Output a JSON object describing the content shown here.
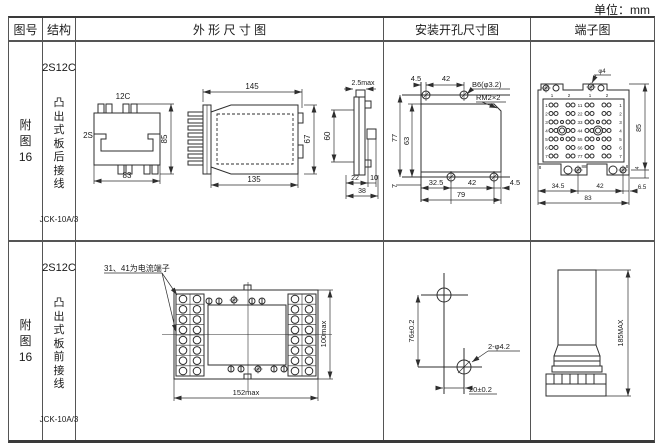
{
  "unit_label": "单位：mm",
  "table": {
    "headers": {
      "fig_no": "图号",
      "structure": "结构",
      "outline": "外 形 尺 寸 图",
      "mounting": "安装开孔尺寸图",
      "terminal": "端子图"
    }
  },
  "rows": [
    {
      "fig_no": "附\n图\n16",
      "model": "2S12C",
      "structure_desc": "凸\n出\n式\n板\n后\n接\n线",
      "relay_code": "JCK-10A/3",
      "outline": {
        "front": {
          "top_label": "12C",
          "left_label": "2S",
          "height": "85",
          "width": "83"
        },
        "side": {
          "top": "145",
          "bottom": "135",
          "height": "67"
        },
        "profile": {
          "top": "2.5max",
          "height": "60",
          "d1": "22",
          "d2": "10",
          "d3": "38"
        }
      },
      "mounting": {
        "t1": "4.5",
        "t2": "42",
        "hole": "B6(φ3.2)",
        "thread": "RM2×2",
        "h1": "77",
        "h2": "63",
        "b0": "7",
        "b1": "32.5",
        "b2": "42",
        "b3": "4.5",
        "total": "79"
      },
      "terminal": {
        "hole": "φ4",
        "col_labels": [
          "1",
          "2",
          "1",
          "2"
        ],
        "left_nums": [
          "1",
          "2",
          "3",
          "4",
          "5",
          "6",
          "7"
        ],
        "center_nums": [
          "11",
          "22",
          "33",
          "44",
          "55",
          "66",
          "77"
        ],
        "right_nums": [
          "1",
          "2",
          "3",
          "4",
          "5",
          "6",
          "7"
        ],
        "bl": "8",
        "bc": "88",
        "br": "8",
        "height": "85",
        "d4": "4",
        "b1": "34.5",
        "b2": "42",
        "b3": "6.5",
        "total": "83"
      }
    },
    {
      "fig_no": "附\n图\n16",
      "model": "2S12C",
      "structure_desc": "凸\n出\n式\n板\n前\n接\n线",
      "relay_code": "JCK-10A/3",
      "outline": {
        "note": "31、41为电流端子",
        "width": "152max",
        "height": "100max"
      },
      "mounting": {
        "v": "76±0.2",
        "hole": "2-φ4.2",
        "h": "20±0.2"
      },
      "terminal": {
        "height": "185MAX"
      }
    }
  ]
}
